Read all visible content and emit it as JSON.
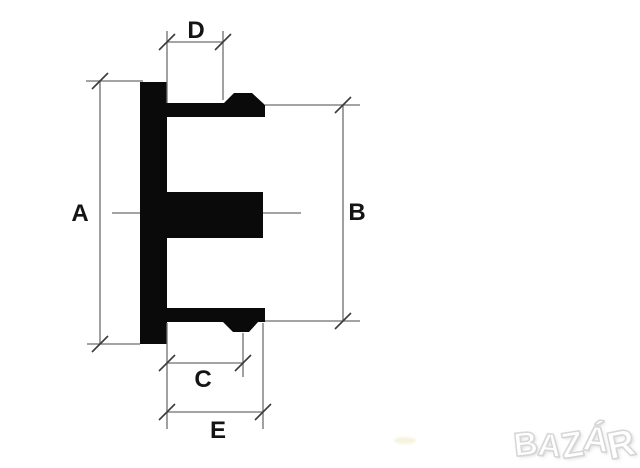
{
  "diagram": {
    "description": "Technical cross-section drawing of a hub/center cap profile with five dimension callouts",
    "dimension_labels": {
      "a": "A",
      "b": "B",
      "c": "C",
      "d": "D",
      "e": "E"
    },
    "watermark": {
      "text": "BAZÁR",
      "letters": [
        "B",
        "A",
        "Z",
        "Á",
        "R"
      ]
    },
    "colors": {
      "background": "#ffffff",
      "part": "#0a0a0a",
      "dimension_lines": "#6e6e6e",
      "tick_marks": "#3a3a3a",
      "label_text": "#141414",
      "watermark_fill": "#ffffff",
      "watermark_outline": "#d6d6d6",
      "smudge": "#efe9c2"
    }
  }
}
